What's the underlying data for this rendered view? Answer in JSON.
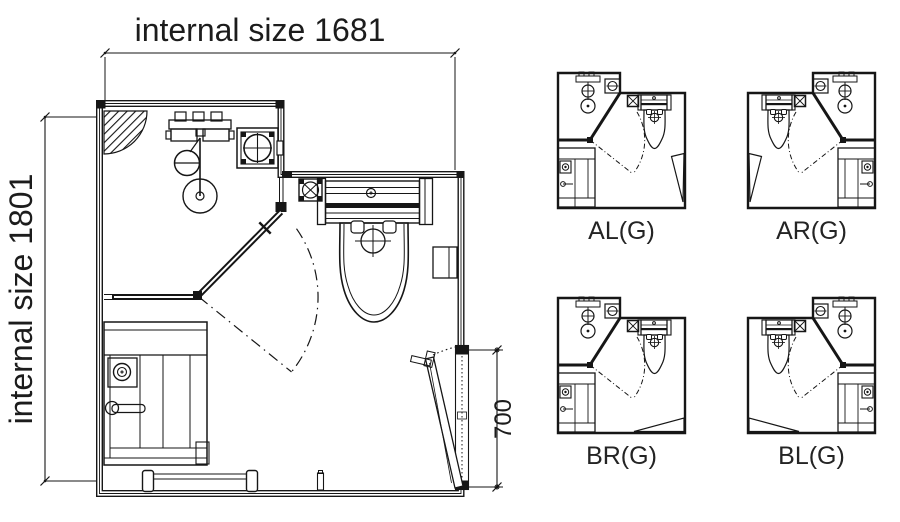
{
  "colors": {
    "ink": "#1a1a1a",
    "line": "#161616",
    "background": "#ffffff"
  },
  "main_plan": {
    "dimension_top_label": "internal size 1681",
    "dimension_left_label": "internal size 1801",
    "dimension_door_label": "700",
    "fixtures": [
      "corner-shower-hatch",
      "shower-mixer",
      "hand-shower",
      "floor-drain",
      "extractor-fan",
      "wall-vent",
      "toilet-with-cistern",
      "toilet-roll-holder",
      "shower-screen-diagonal",
      "shower-door-swing-arc",
      "entrance-door",
      "door-swing-dots",
      "towel-rail",
      "door-stopper",
      "vanity-basin-unit"
    ]
  },
  "variants": {
    "items": [
      {
        "label": "AL(G)",
        "door_position": "right",
        "mirrored": false
      },
      {
        "label": "AR(G)",
        "door_position": "right",
        "mirrored": true
      },
      {
        "label": "BR(G)",
        "door_position": "bottom",
        "mirrored": false
      },
      {
        "label": "BL(G)",
        "door_position": "bottom",
        "mirrored": true
      }
    ]
  }
}
